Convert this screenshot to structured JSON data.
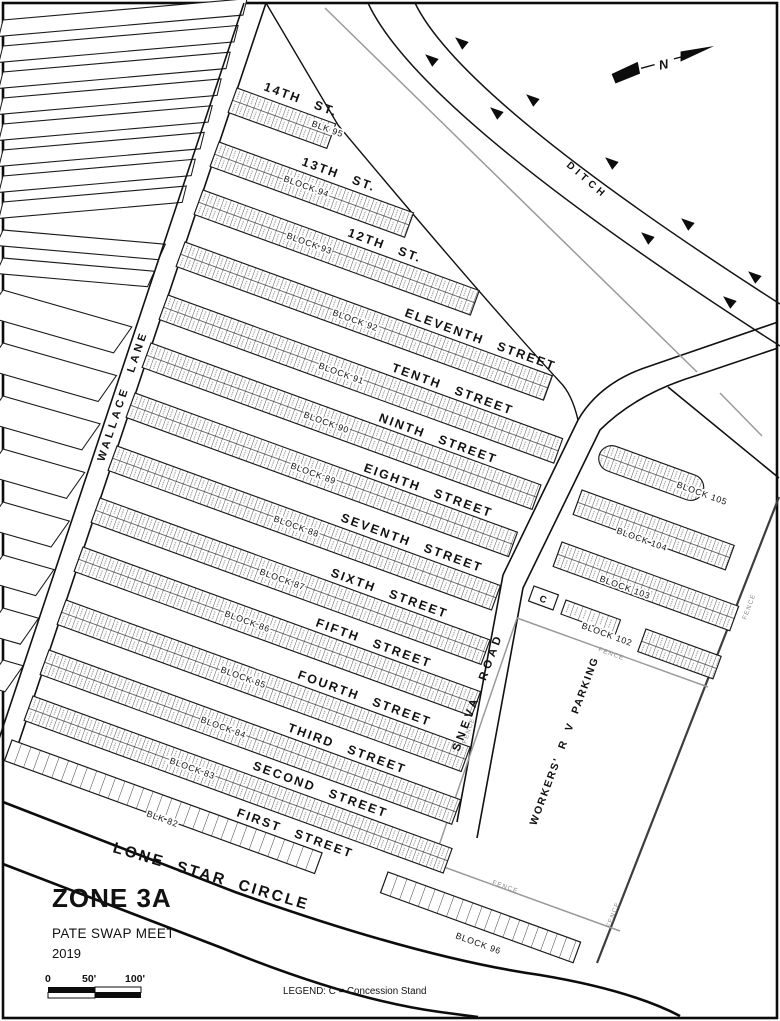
{
  "title": {
    "zone": "ZONE  3A",
    "meet": "PATE SWAP MEET",
    "year": "2019"
  },
  "legend_text": "LEGEND:  C = Concession Stand",
  "scale": {
    "zero": "0",
    "fifty": "50'",
    "hundred": "100'"
  },
  "north_label": "N",
  "roads": {
    "wallace": "WALLACE LANE",
    "sneva": "SNEVA ROAD",
    "lone_star": "LONE STAR CIRCLE",
    "ditch": "DITCH"
  },
  "areas": {
    "rv_parking": "WORKERS' R V PARKING",
    "fence": "FENCE",
    "concession": "C"
  },
  "streets": [
    "14TH ST.",
    "13TH ST.",
    "12TH ST.",
    "ELEVENTH STREET",
    "TENTH STREET",
    "NINTH STREET",
    "EIGHTH STREET",
    "SEVENTH STREET",
    "SIXTH STREET",
    "FIFTH STREET",
    "FOURTH STREET",
    "THIRD STREET",
    "SECOND STREET",
    "FIRST STREET"
  ],
  "blocks": {
    "b95": "BLK 95",
    "b94": "BLOCK 94",
    "b93": "BLOCK 93",
    "b92": "BLOCK 92",
    "b91": "BLOCK 91",
    "b90": "BLOCK 90",
    "b89": "BLOCK 89",
    "b88": "BLOCK 88",
    "b87": "BLOCK 87",
    "b86": "BLOCK 86",
    "b85": "BLOCK 85",
    "b84": "BLOCK 84",
    "b83": "BLOCK 83",
    "b82": "BLK 82",
    "b96": "BLOCK 96",
    "b102": "BLOCK 102",
    "b103": "BLOCK 103",
    "b104": "BLOCK 104",
    "b105": "BLOCK 105"
  }
}
